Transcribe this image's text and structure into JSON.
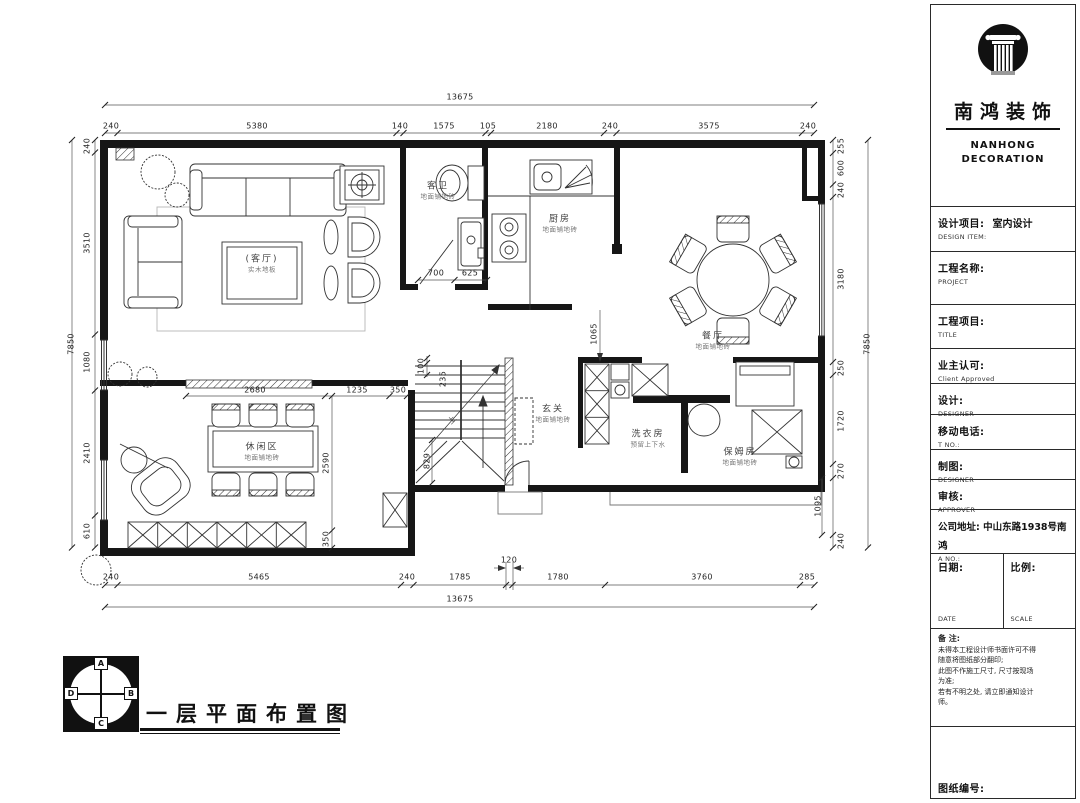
{
  "title_block": {
    "brand": {
      "name": "南鸿装饰",
      "sub1": "NANHONG",
      "sub2": "DECORATION"
    },
    "design_item": {
      "label": "设计项目:",
      "sub": "DESIGN ITEM:",
      "value": "室内设计"
    },
    "project_name": {
      "label": "工程名称:",
      "sub": "PROJECT"
    },
    "project_title": {
      "label": "工程项目:",
      "sub": "TITLE"
    },
    "client": {
      "label": "业主认可:",
      "sub": "Client Approved"
    },
    "design": {
      "label": "设计:",
      "sub": "DESIGNER"
    },
    "mobile": {
      "label": "移动电话:",
      "sub": "T NO.:"
    },
    "draft": {
      "label": "制图:",
      "sub": "DESIGNER"
    },
    "review": {
      "label": "审核:",
      "sub": "APPROVER"
    },
    "address": {
      "label": "公司地址: 中山东路1938号南鸿",
      "sub": "A NO.:"
    },
    "date": {
      "label": "日期:",
      "sub": "DATE"
    },
    "scale": {
      "label": "比例:",
      "sub": "SCALE"
    },
    "notes": {
      "title": "备 注:",
      "lines": [
        "未得本工程设计师书面许可不得",
        "随意将图纸部分翻印;",
        "此图不作施工尺寸, 尺寸按现场",
        "为准;",
        "若有不明之处, 请立即通知设计",
        "师。"
      ]
    },
    "sheet_no": {
      "label": "图纸编号:"
    }
  },
  "drawing": {
    "title": "一层平面布置图",
    "compass": {
      "a": "A",
      "b": "B",
      "c": "C",
      "d": "D"
    }
  },
  "rooms": {
    "living": {
      "name": "(客厅)",
      "sub": "实木地板"
    },
    "bath": {
      "name": "客卫",
      "sub": "地面铺地砖"
    },
    "kitchen": {
      "name": "厨房",
      "sub": "地面铺地砖"
    },
    "dining": {
      "name": "餐厅",
      "sub": "地面铺地砖"
    },
    "foyer": {
      "name": "玄关",
      "sub": "地面铺地砖"
    },
    "lounge": {
      "name": "休闲区",
      "sub": "地面铺地砖"
    },
    "laundry": {
      "name": "洗衣房",
      "sub": "预留上下水"
    },
    "maid": {
      "name": "保姆房",
      "sub": "地面铺地砖"
    },
    "stair_up": "上"
  },
  "dims": {
    "top_total": "13675",
    "top": [
      "240",
      "5380",
      "140",
      "1575",
      "105",
      "2180",
      "240",
      "3575",
      "240"
    ],
    "bottom_total": "13675",
    "bottom": [
      "240",
      "5465",
      "240",
      "1785",
      "1780",
      "3760",
      "285"
    ],
    "bottom_gap": "120",
    "left_total": "7850",
    "left": [
      "240",
      "3510",
      "1080",
      "2410",
      "610"
    ],
    "right_total": "7850",
    "right": [
      "255",
      "600",
      "240",
      "3180",
      "250",
      "1720",
      "270",
      "240"
    ],
    "right_inner": "1095",
    "inner": {
      "a700": "700",
      "a625": "625",
      "a2680": "2680",
      "a1235": "1235",
      "a350": "350",
      "a2590": "2590",
      "a350b": "350",
      "a100": "100",
      "a235": "235",
      "a829": "829",
      "a1065": "1065"
    }
  }
}
